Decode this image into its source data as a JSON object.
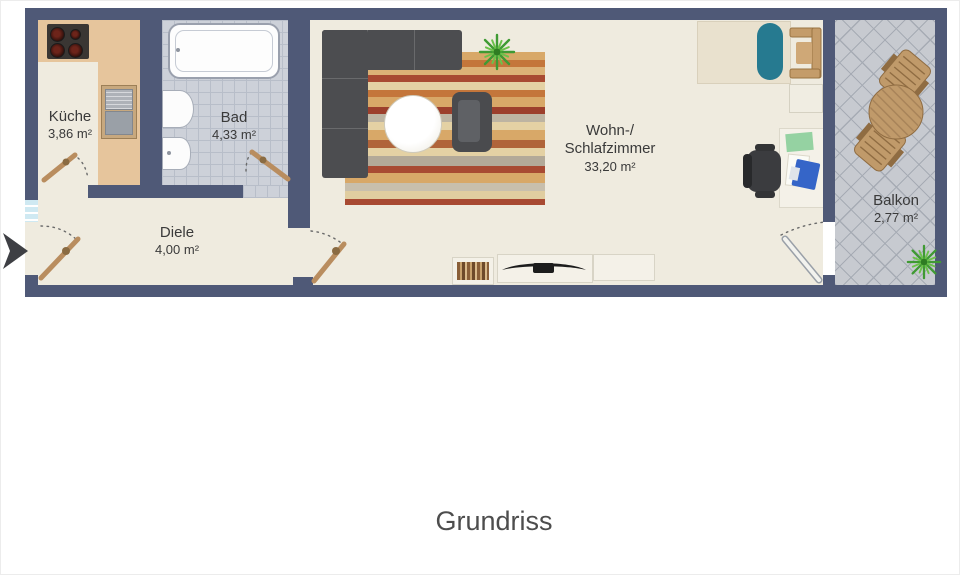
{
  "title": "Grundriss",
  "rooms": {
    "kueche": {
      "name": "Küche",
      "area": "3,86 m²"
    },
    "bad": {
      "name": "Bad",
      "area": "4,33 m²"
    },
    "diele": {
      "name": "Diele",
      "area": "4,00 m²"
    },
    "wohn_schlafzimmer": {
      "name_line1": "Wohn-/",
      "name_line2": "Schlafzimmer",
      "area": "33,20 m²"
    },
    "balkon": {
      "name": "Balkon",
      "area": "2,77 m²"
    }
  },
  "icons": {
    "entrance_arrow": "right-pointing entrance arrow"
  },
  "colors": {
    "wall": "#4f5977",
    "floor": "#efebdf",
    "kitchen_counter": "#e6c59c",
    "bath_tile": "#cdd1d9",
    "balcony_tile": "#c7cad0",
    "sofa_gray": "#4c4d50",
    "bed_blanket_teal": "#267a90",
    "wood": "#bd9365",
    "plant_green": "#58b43e",
    "laptop_blue": "#3565c8",
    "desk_pad_green": "#95d2a2",
    "label_text": "#3a3a3a"
  }
}
